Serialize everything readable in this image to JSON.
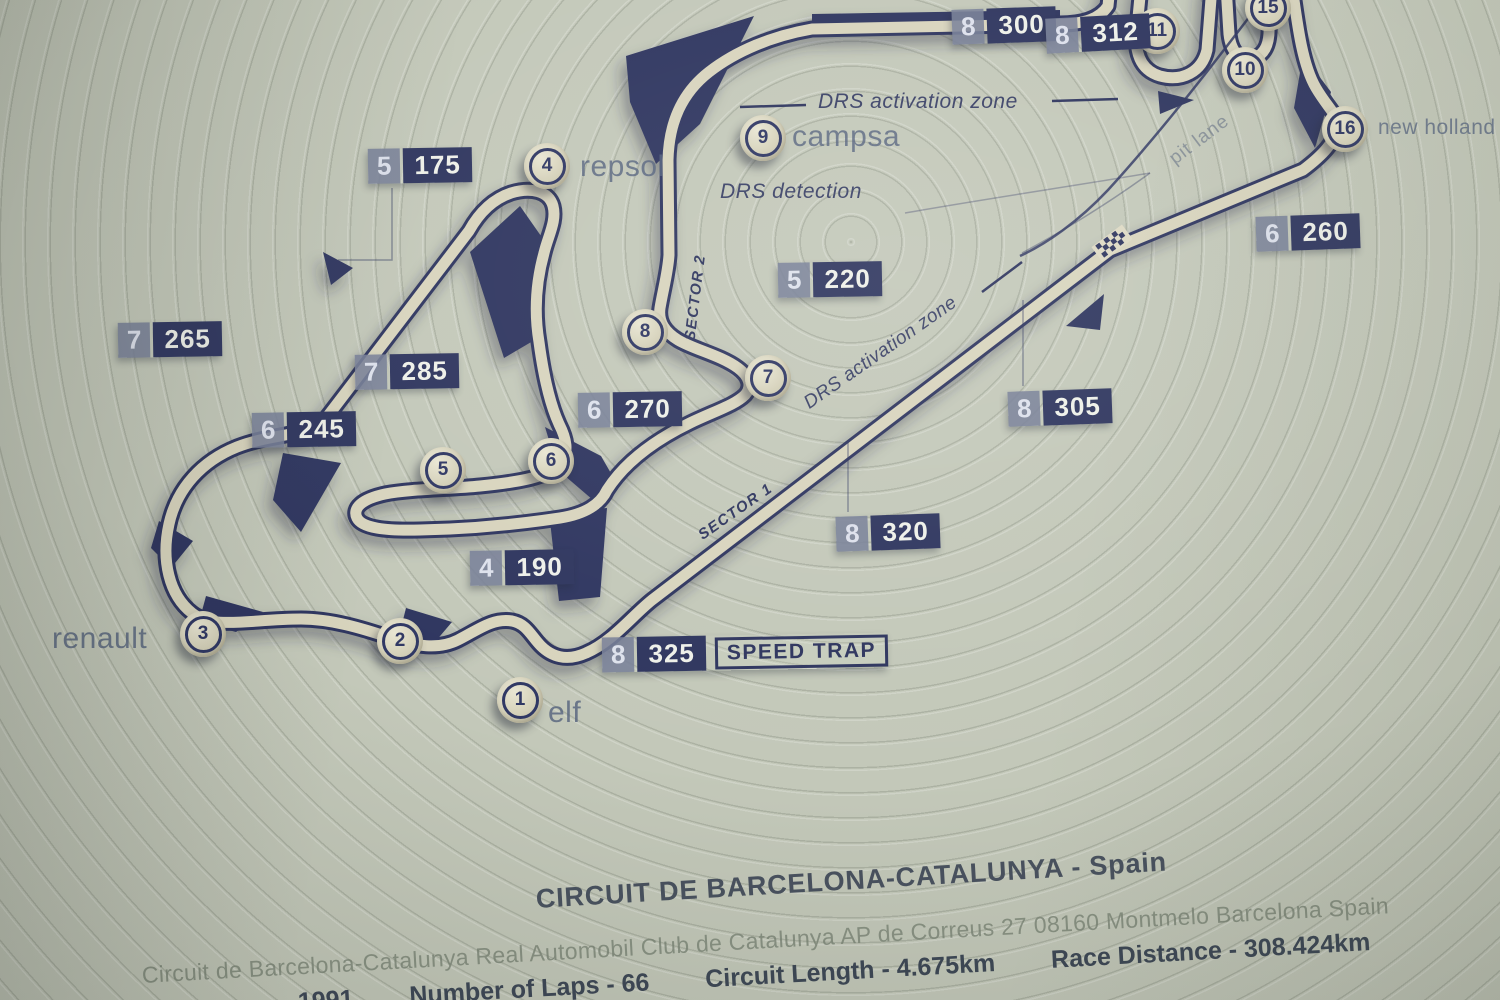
{
  "map": {
    "turns": [
      {
        "num": "1",
        "label": "elf"
      },
      {
        "num": "2"
      },
      {
        "num": "3",
        "label": "renault"
      },
      {
        "num": "4",
        "label": "repsol"
      },
      {
        "num": "5"
      },
      {
        "num": "6"
      },
      {
        "num": "7"
      },
      {
        "num": "8"
      },
      {
        "num": "9",
        "label": "campsa"
      },
      {
        "num": "10"
      },
      {
        "num": "11"
      },
      {
        "num": "15"
      },
      {
        "num": "16",
        "label": "new holland"
      }
    ],
    "badges": [
      {
        "gear": "5",
        "speed": "175"
      },
      {
        "gear": "8",
        "speed": "300"
      },
      {
        "gear": "8",
        "speed": "312"
      },
      {
        "gear": "6",
        "speed": "260"
      },
      {
        "gear": "5",
        "speed": "220"
      },
      {
        "gear": "7",
        "speed": "265"
      },
      {
        "gear": "7",
        "speed": "285"
      },
      {
        "gear": "6",
        "speed": "270"
      },
      {
        "gear": "6",
        "speed": "245"
      },
      {
        "gear": "8",
        "speed": "305"
      },
      {
        "gear": "8",
        "speed": "320"
      },
      {
        "gear": "4",
        "speed": "190"
      },
      {
        "gear": "8",
        "speed": "325",
        "note": "SPEED TRAP"
      }
    ],
    "zones": {
      "drs_activation": "DRS activation zone",
      "drs_detection": "DRS detection",
      "sector1": "SECTOR 1",
      "sector2": "SECTOR 2",
      "pit_lane": "pit lane"
    }
  },
  "footer": {
    "title": "CIRCUIT DE BARCELONA-CATALUNYA - Spain",
    "subtitle": "Circuit de Barcelona-Catalunya Real Automobil Club de Catalunya AP de Correus 27 08160 Montmelo Barcelona Spain",
    "year": "1991",
    "laps": "Number of Laps - 66",
    "length": "Circuit Length - 4.675km",
    "distance": "Race Distance - 308.424km"
  },
  "colors": {
    "plate": "#c3c8b9",
    "track_cream": "#d8d4bd",
    "navy": "#2e355e",
    "badge_gear_bg": "#767e96",
    "label_blue": "#52607c"
  }
}
